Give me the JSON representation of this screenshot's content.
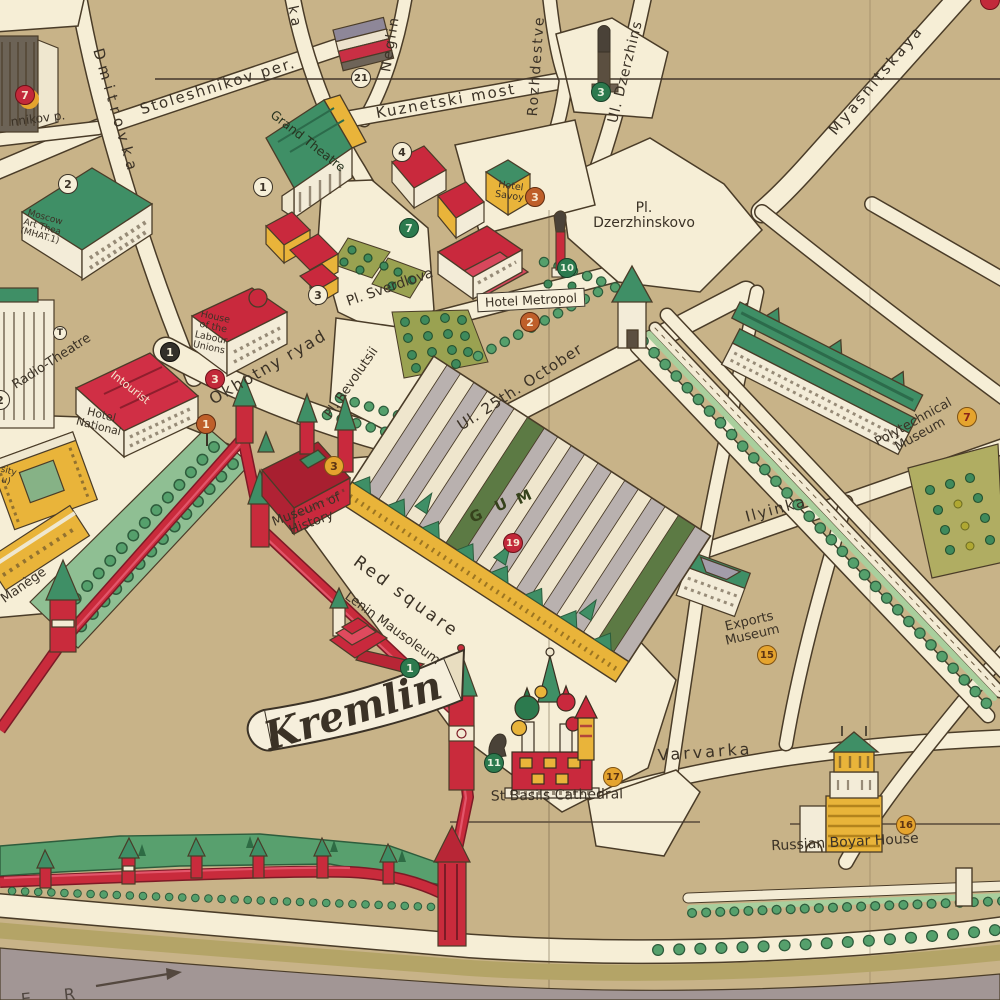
{
  "map": {
    "banner": {
      "kremlin": "Kremlin"
    },
    "streets": {
      "stoleshnikov": "Stoleshnikov per.",
      "stoleshnikov_partial": "nnikov p.",
      "dmitrovka": "Dmitrovka",
      "petrovka_partial": "ka",
      "neglinnaya": "Neglin",
      "kuznetski": "Kuznetski most",
      "rozhdestvenka": "Rozhdestve",
      "dzerzhinskogo": "Ul. Dzerzhins",
      "myasnitskaya": "Myasnitskaya",
      "okhotny": "Okhotny ryad",
      "ilyinka": "Ilyinka",
      "varvarka": "Varvarka",
      "ul_25_october": "Ul. 25th. October"
    },
    "squares": {
      "pl_dzerzhinskovo_l1": "Pl.",
      "pl_dzerzhinskovo_l2": "Dzerzhinskovo",
      "pl_sverdlova": "Pl. Sverdlova",
      "pl_revolutsii": "Pl. Revolutsii",
      "red_square": "Red square"
    },
    "buildings": {
      "grand_theatre": "Grand Theatre",
      "moscow_art_l1": "Moscow",
      "moscow_art_l2": "Art Thea",
      "moscow_art_l3": "(MHAT.1)",
      "radio_theatre": "Radio-Theatre",
      "labour_unions_l1": "House",
      "labour_unions_l2": "of the",
      "labour_unions_l3": "Labour",
      "labour_unions_l4": "Unions",
      "hotel_national_l1": "Hotel",
      "hotel_national_l2": "National",
      "intourist": "Intourist",
      "hotel_metropol": "Hotel Metropol",
      "hotel_savoy_l1": "Hotel",
      "hotel_savoy_l2": "Savoy",
      "museum_history_l1": "Museum of",
      "museum_history_l2": "History",
      "lenin_mausoleum": "Lenin Mausoleum",
      "st_basils": "St Basils Cathedral",
      "polytechnical_l1": "Polytechnical",
      "polytechnical_l2": "Museum",
      "exports_l1": "Exports",
      "exports_l2": "Museum",
      "boyar_house": "Russian Boyar House",
      "maniege": "Manège",
      "university_partial_l1": "sity",
      "university_partial_l2": "u)"
    },
    "gum_roof": {
      "g": "G",
      "u": "U",
      "m": "M"
    },
    "river": {
      "letters": "E R"
    },
    "badges": {
      "dmitrovka_7": "7",
      "mat_2": "2",
      "grand_1": "1",
      "tsum_21": "21",
      "kuznetski_4": "4",
      "savoy_3": "3",
      "lubyanka_3": "3",
      "gardens_7": "7",
      "metropol_10": "10",
      "metropol_2": "2",
      "national_1": "1",
      "unions_3": "3",
      "okhotny_1": "1",
      "houses_3": "3",
      "history_3": "3",
      "gum_19": "19",
      "mausoleum_1": "1",
      "minin_11": "11",
      "basils_17": "17",
      "exports_15": "15",
      "boyar_16": "16",
      "poly_7": "7",
      "radio_2": "2",
      "roof_t": "T"
    },
    "colors": {
      "paper_road": "#f6eed6",
      "block_tan": "#c8b388",
      "outline_ink": "#4a3c28",
      "roof_green": "#3f8f66",
      "garden_green": "#8fbf93",
      "bed_olive": "#9aa251",
      "building_red": "#c9293d",
      "building_yellow": "#e9b43a",
      "gum_gray": "#b9b1af",
      "river_gray": "#a29695",
      "bank_olive": "#b4a467",
      "badge_yellow": "#e5a42e",
      "badge_orange": "#bf5f2a",
      "badge_red": "#c2293a",
      "badge_green": "#2c7a4e",
      "badge_black": "#33302a"
    }
  }
}
